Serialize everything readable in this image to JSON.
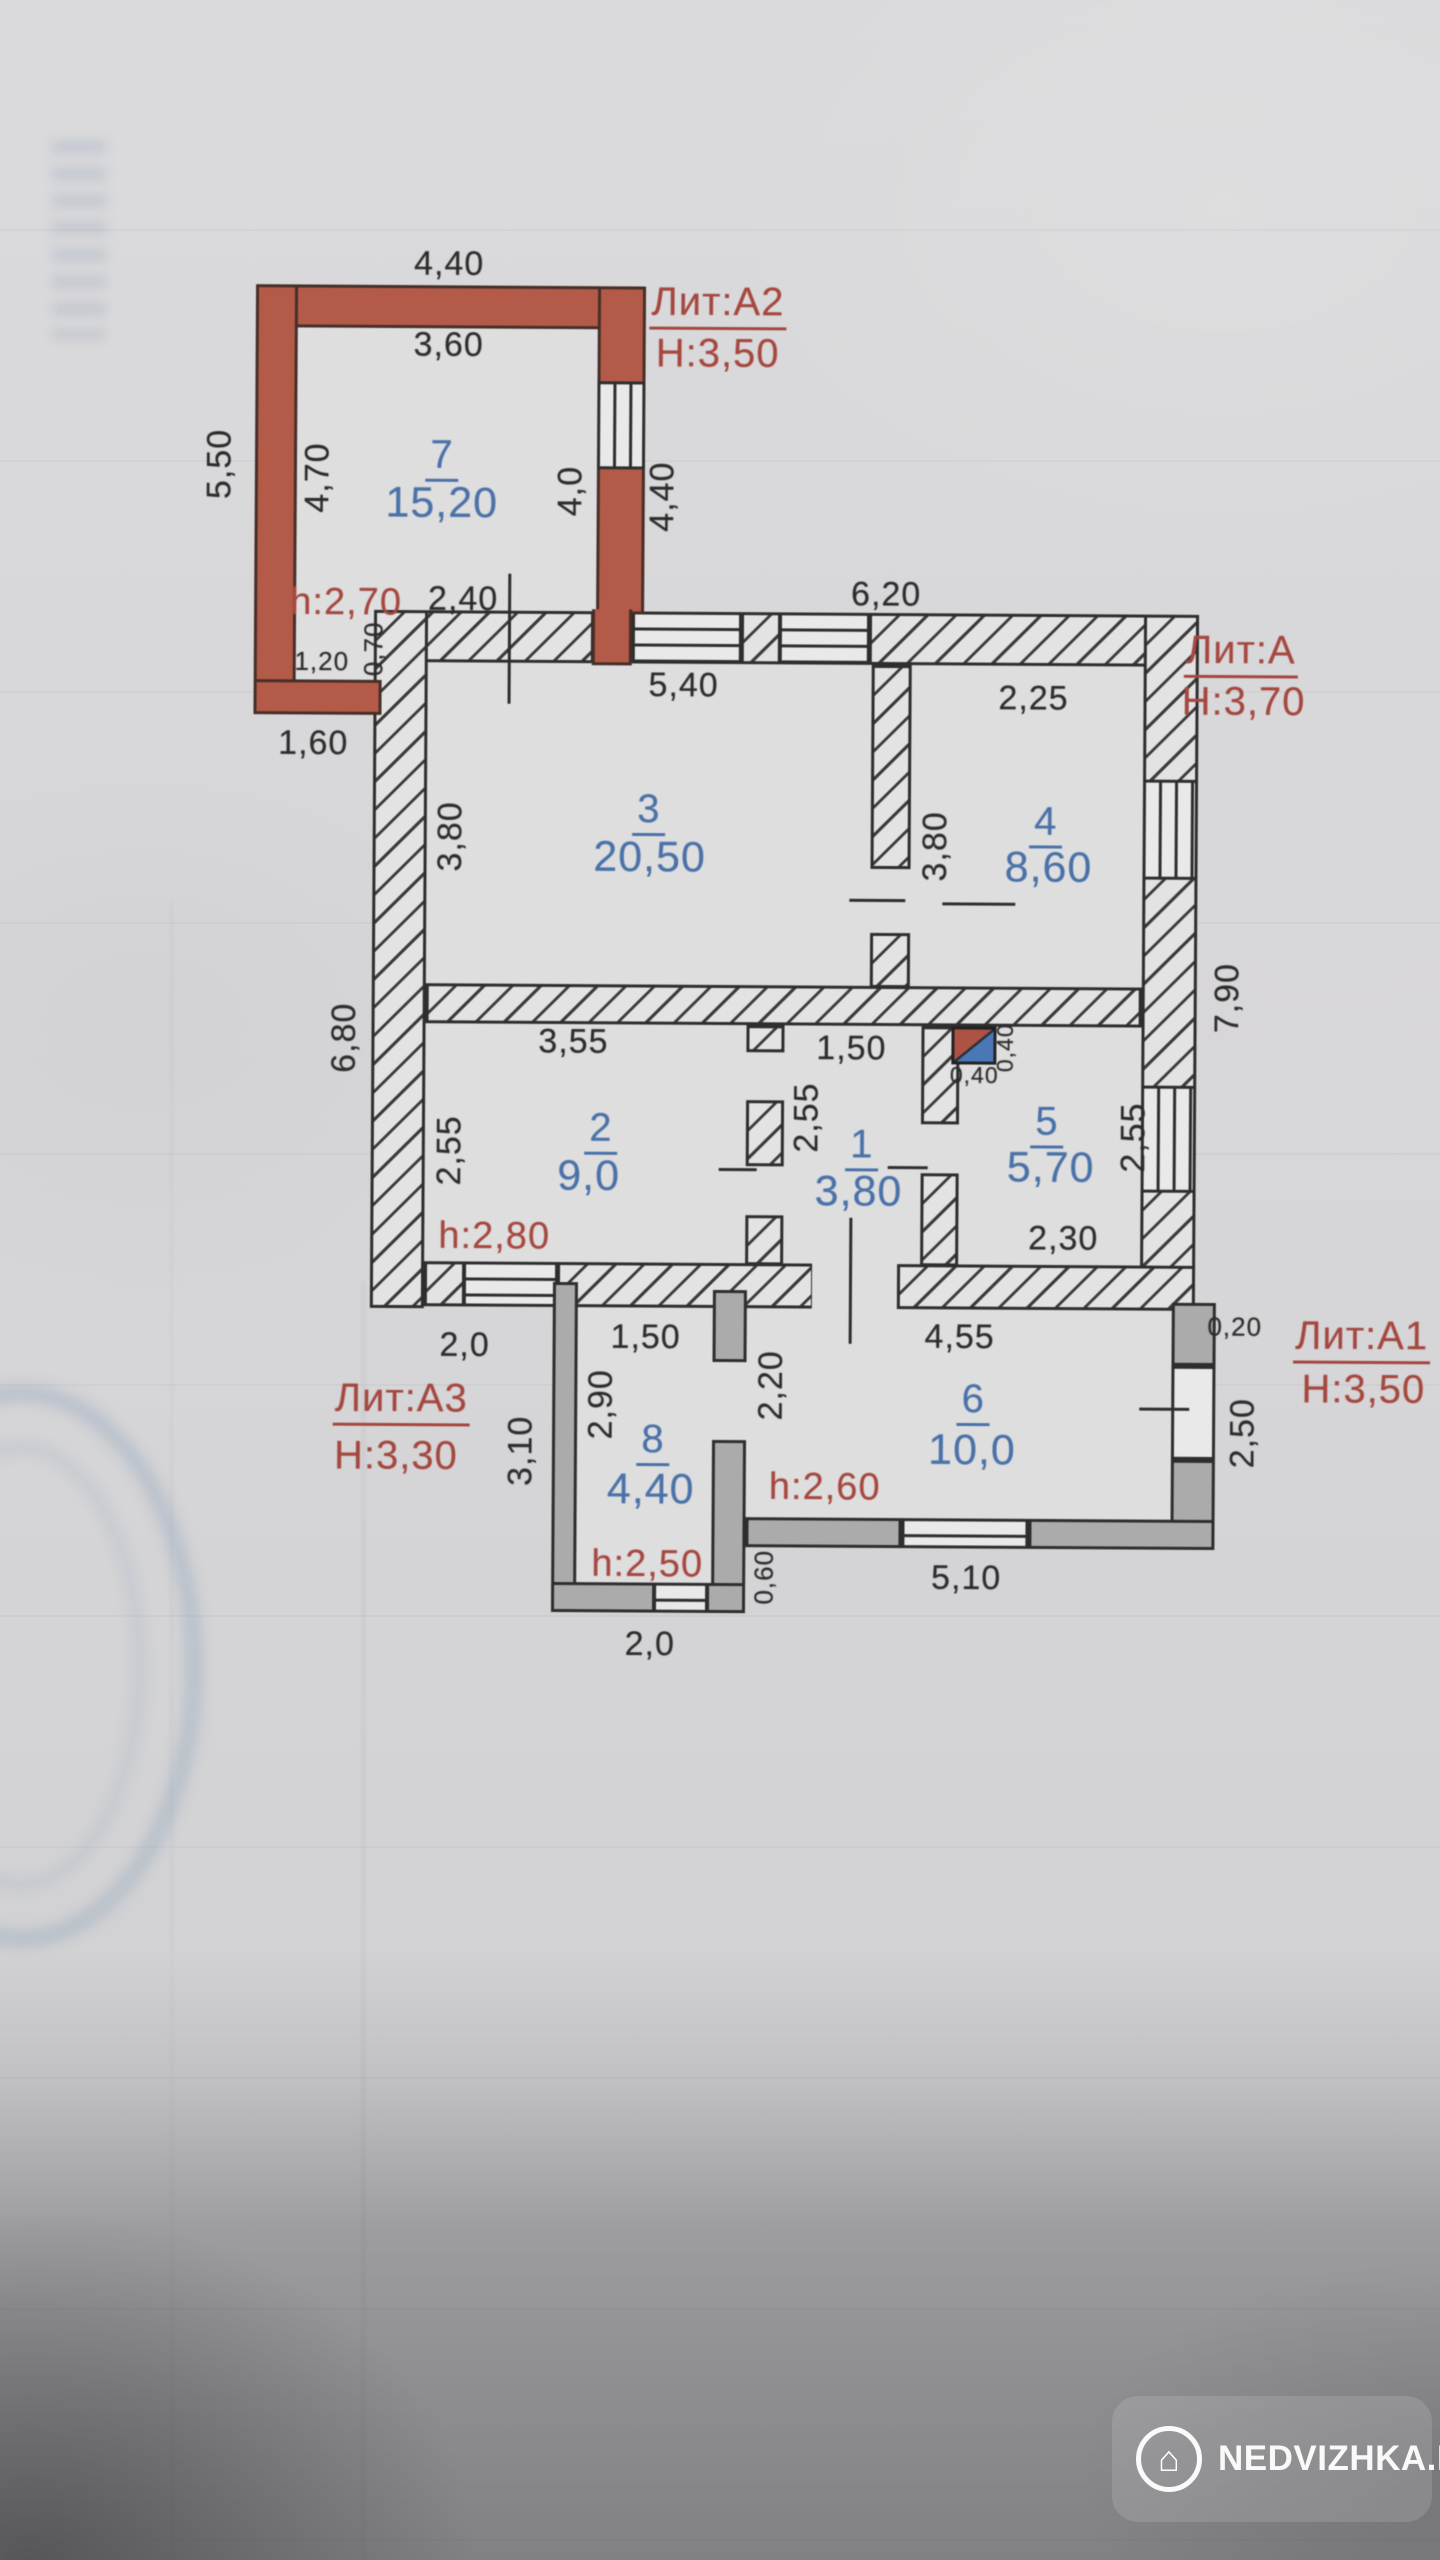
{
  "blocks": {
    "a2": {
      "lit": "Лит:А2",
      "h": "Н:3,50"
    },
    "a": {
      "lit": "Лит:А",
      "h": "Н:3,70"
    },
    "a3": {
      "lit": "Лит:А3",
      "h": "Н:3,30"
    },
    "a1": {
      "lit": "Лит:А1",
      "h": "Н:3,50"
    }
  },
  "rooms": {
    "r1": {
      "num": "1",
      "area": "3,80"
    },
    "r2": {
      "num": "2",
      "area": "9,0",
      "ceiling": "h:2,80"
    },
    "r3": {
      "num": "3",
      "area": "20,50"
    },
    "r4": {
      "num": "4",
      "area": "8,60"
    },
    "r5": {
      "num": "5",
      "area": "5,70"
    },
    "r6": {
      "num": "6",
      "area": "10,0",
      "ceiling": "h:2,60"
    },
    "r7": {
      "num": "7",
      "area": "15,20",
      "ceiling": "h:2,70"
    },
    "r8": {
      "num": "8",
      "area": "4,40",
      "ceiling": "h:2,50"
    }
  },
  "dims": {
    "a2_top_outer": "4,40",
    "a2_top_inner": "3,60",
    "a2_left_outer": "5,50",
    "a2_left_inner": "4,70",
    "a2_right_inner": "4,0",
    "a2_right_outer": "4,40",
    "a2_bottom_inner": "1,20",
    "a2_bottom_small": "0,70",
    "a2_below": "1,60",
    "a_top_left": "2,40",
    "a_top_right": "6,20",
    "a_left": "6,80",
    "a_right": "7,90",
    "r3_w": "5,40",
    "r3_h": "3,80",
    "r4_w": "2,25",
    "r4_h": "3,80",
    "r2_w": "3,55",
    "r2_h": "2,55",
    "r1_w": "1,50",
    "r1_h": "2,55",
    "r5_w": "2,30",
    "r5_h": "2,55",
    "stove_w": "0,40",
    "stove_h": "0,40",
    "a3_above": "2,0",
    "a3_left": "3,10",
    "r8_w": "1,50",
    "r8_h": "2,90",
    "r8_bottom": "2,0",
    "r6_w": "4,55",
    "r6_left": "2,20",
    "r6_bottom": "5,10",
    "a1_offset": "0,20",
    "a1_right": "2,50",
    "a1_step": "0,60"
  },
  "watermark": {
    "text": "NEDVIZHKA.KZ",
    "icon": "house-icon"
  },
  "colors": {
    "wall_red": "#b45a49",
    "wall_gray": "#ababac",
    "text_blue": "#4a72a8",
    "text_red": "#a5473e",
    "line": "#2e2e2e"
  }
}
